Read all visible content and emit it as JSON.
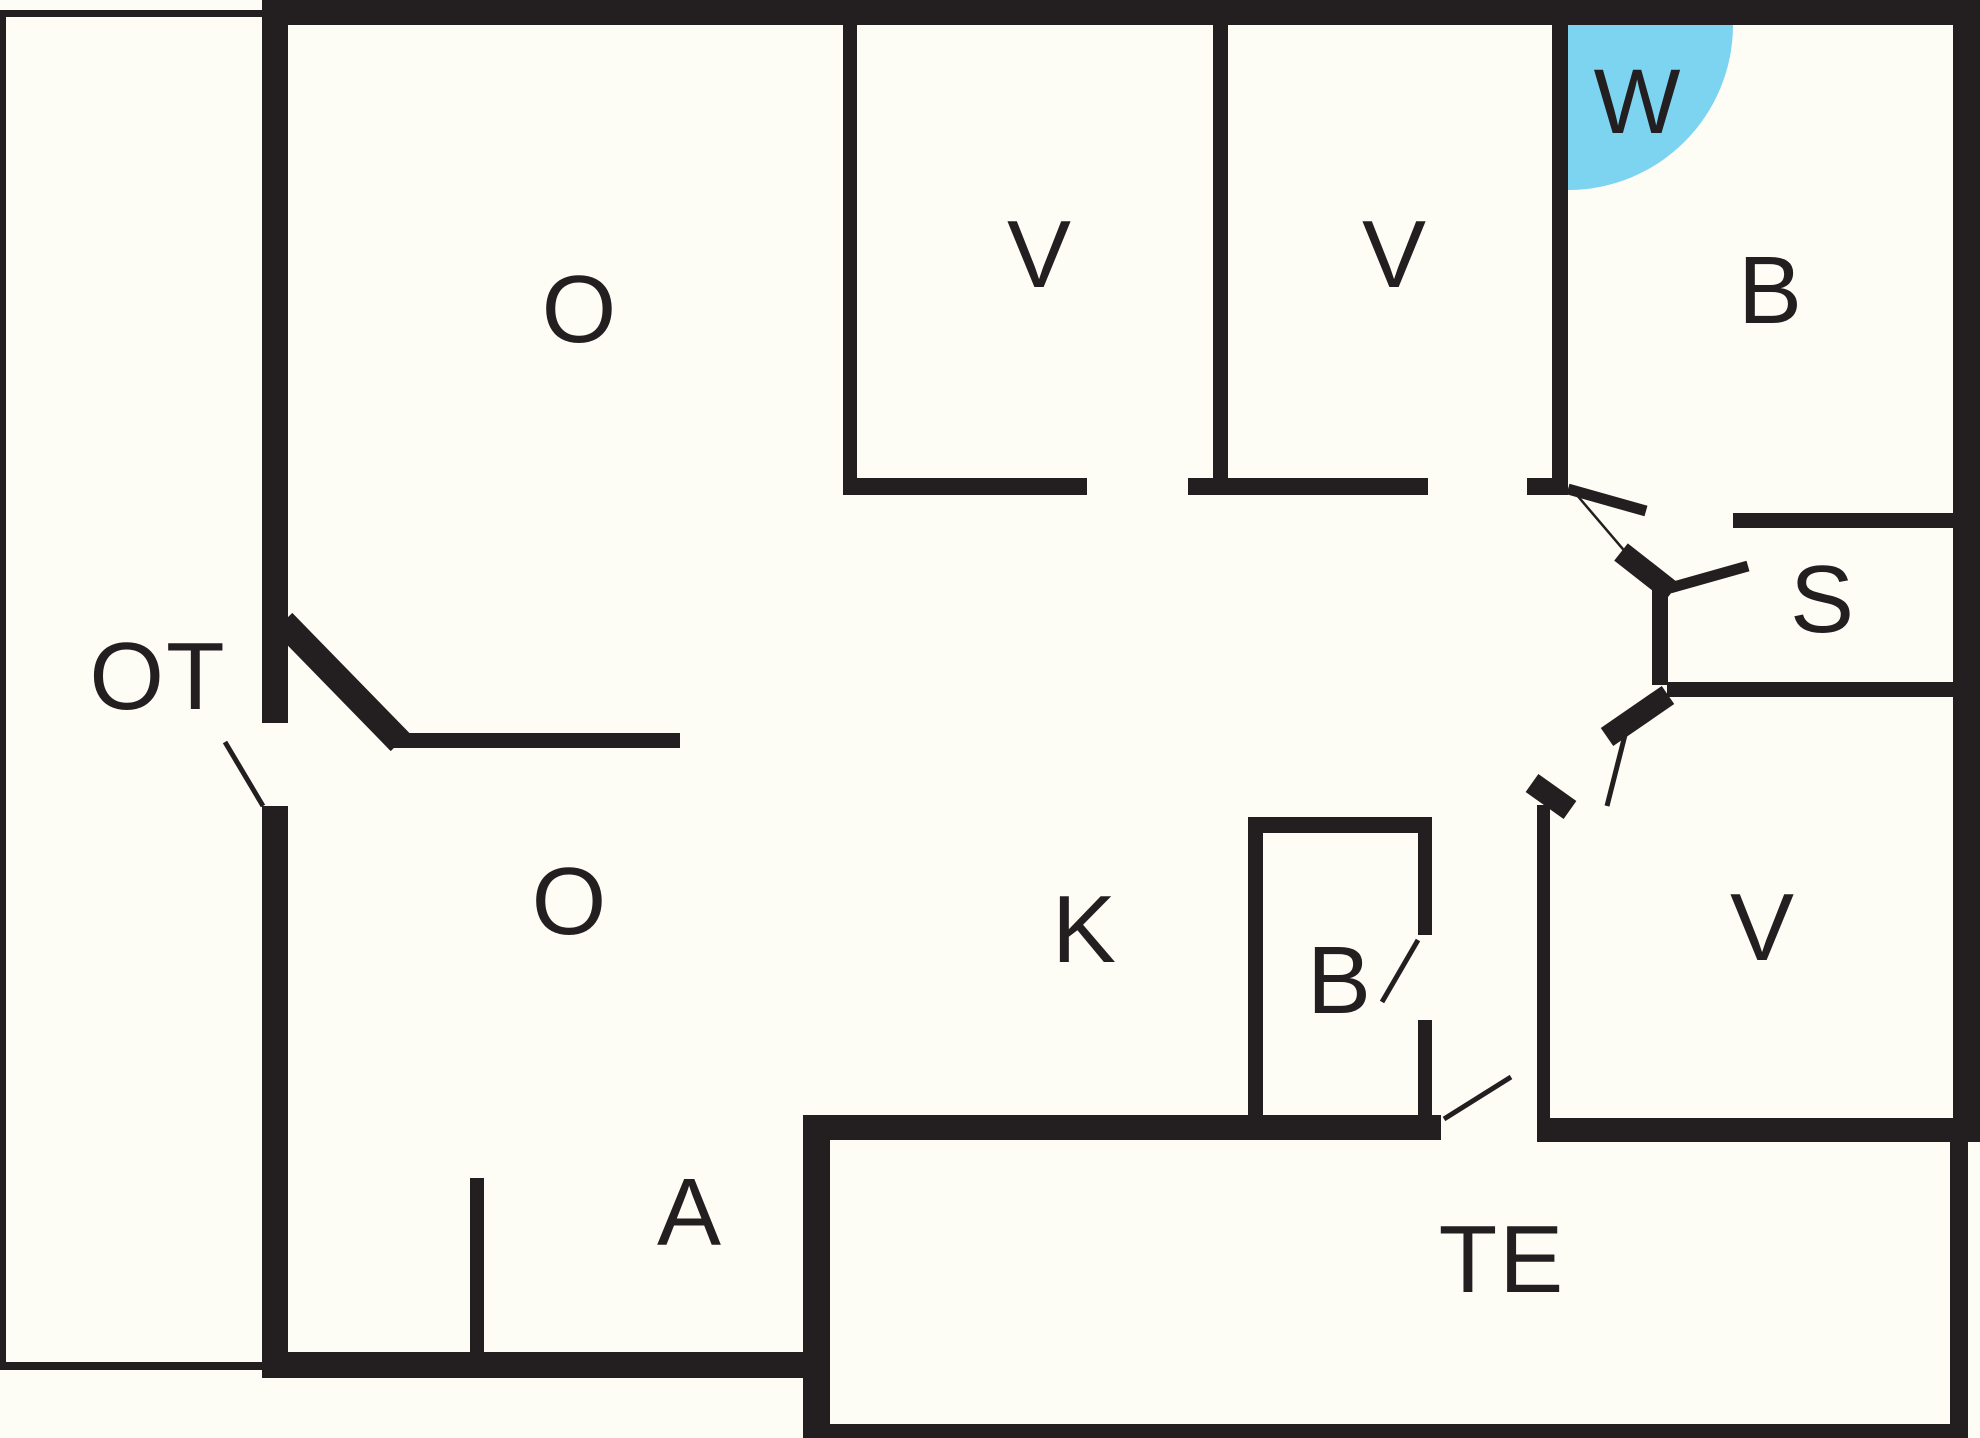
{
  "drawing": {
    "type": "floor-plan",
    "background_color": "#FDFDF6",
    "wall_color": "#231F20",
    "highlight_color": "#7DD4F0",
    "highlight_shape": "quarter-circle-door-swing"
  },
  "rooms": [
    {
      "id": "ot",
      "label": "OT"
    },
    {
      "id": "o-upper",
      "label": "O"
    },
    {
      "id": "v-top-1",
      "label": "V"
    },
    {
      "id": "v-top-2",
      "label": "V"
    },
    {
      "id": "w",
      "label": "W"
    },
    {
      "id": "b-right",
      "label": "B"
    },
    {
      "id": "s",
      "label": "S"
    },
    {
      "id": "o-lower",
      "label": "O"
    },
    {
      "id": "k",
      "label": "K"
    },
    {
      "id": "b-closet",
      "label": "B"
    },
    {
      "id": "v-lower",
      "label": "V"
    },
    {
      "id": "a",
      "label": "A"
    },
    {
      "id": "te",
      "label": "TE"
    }
  ]
}
